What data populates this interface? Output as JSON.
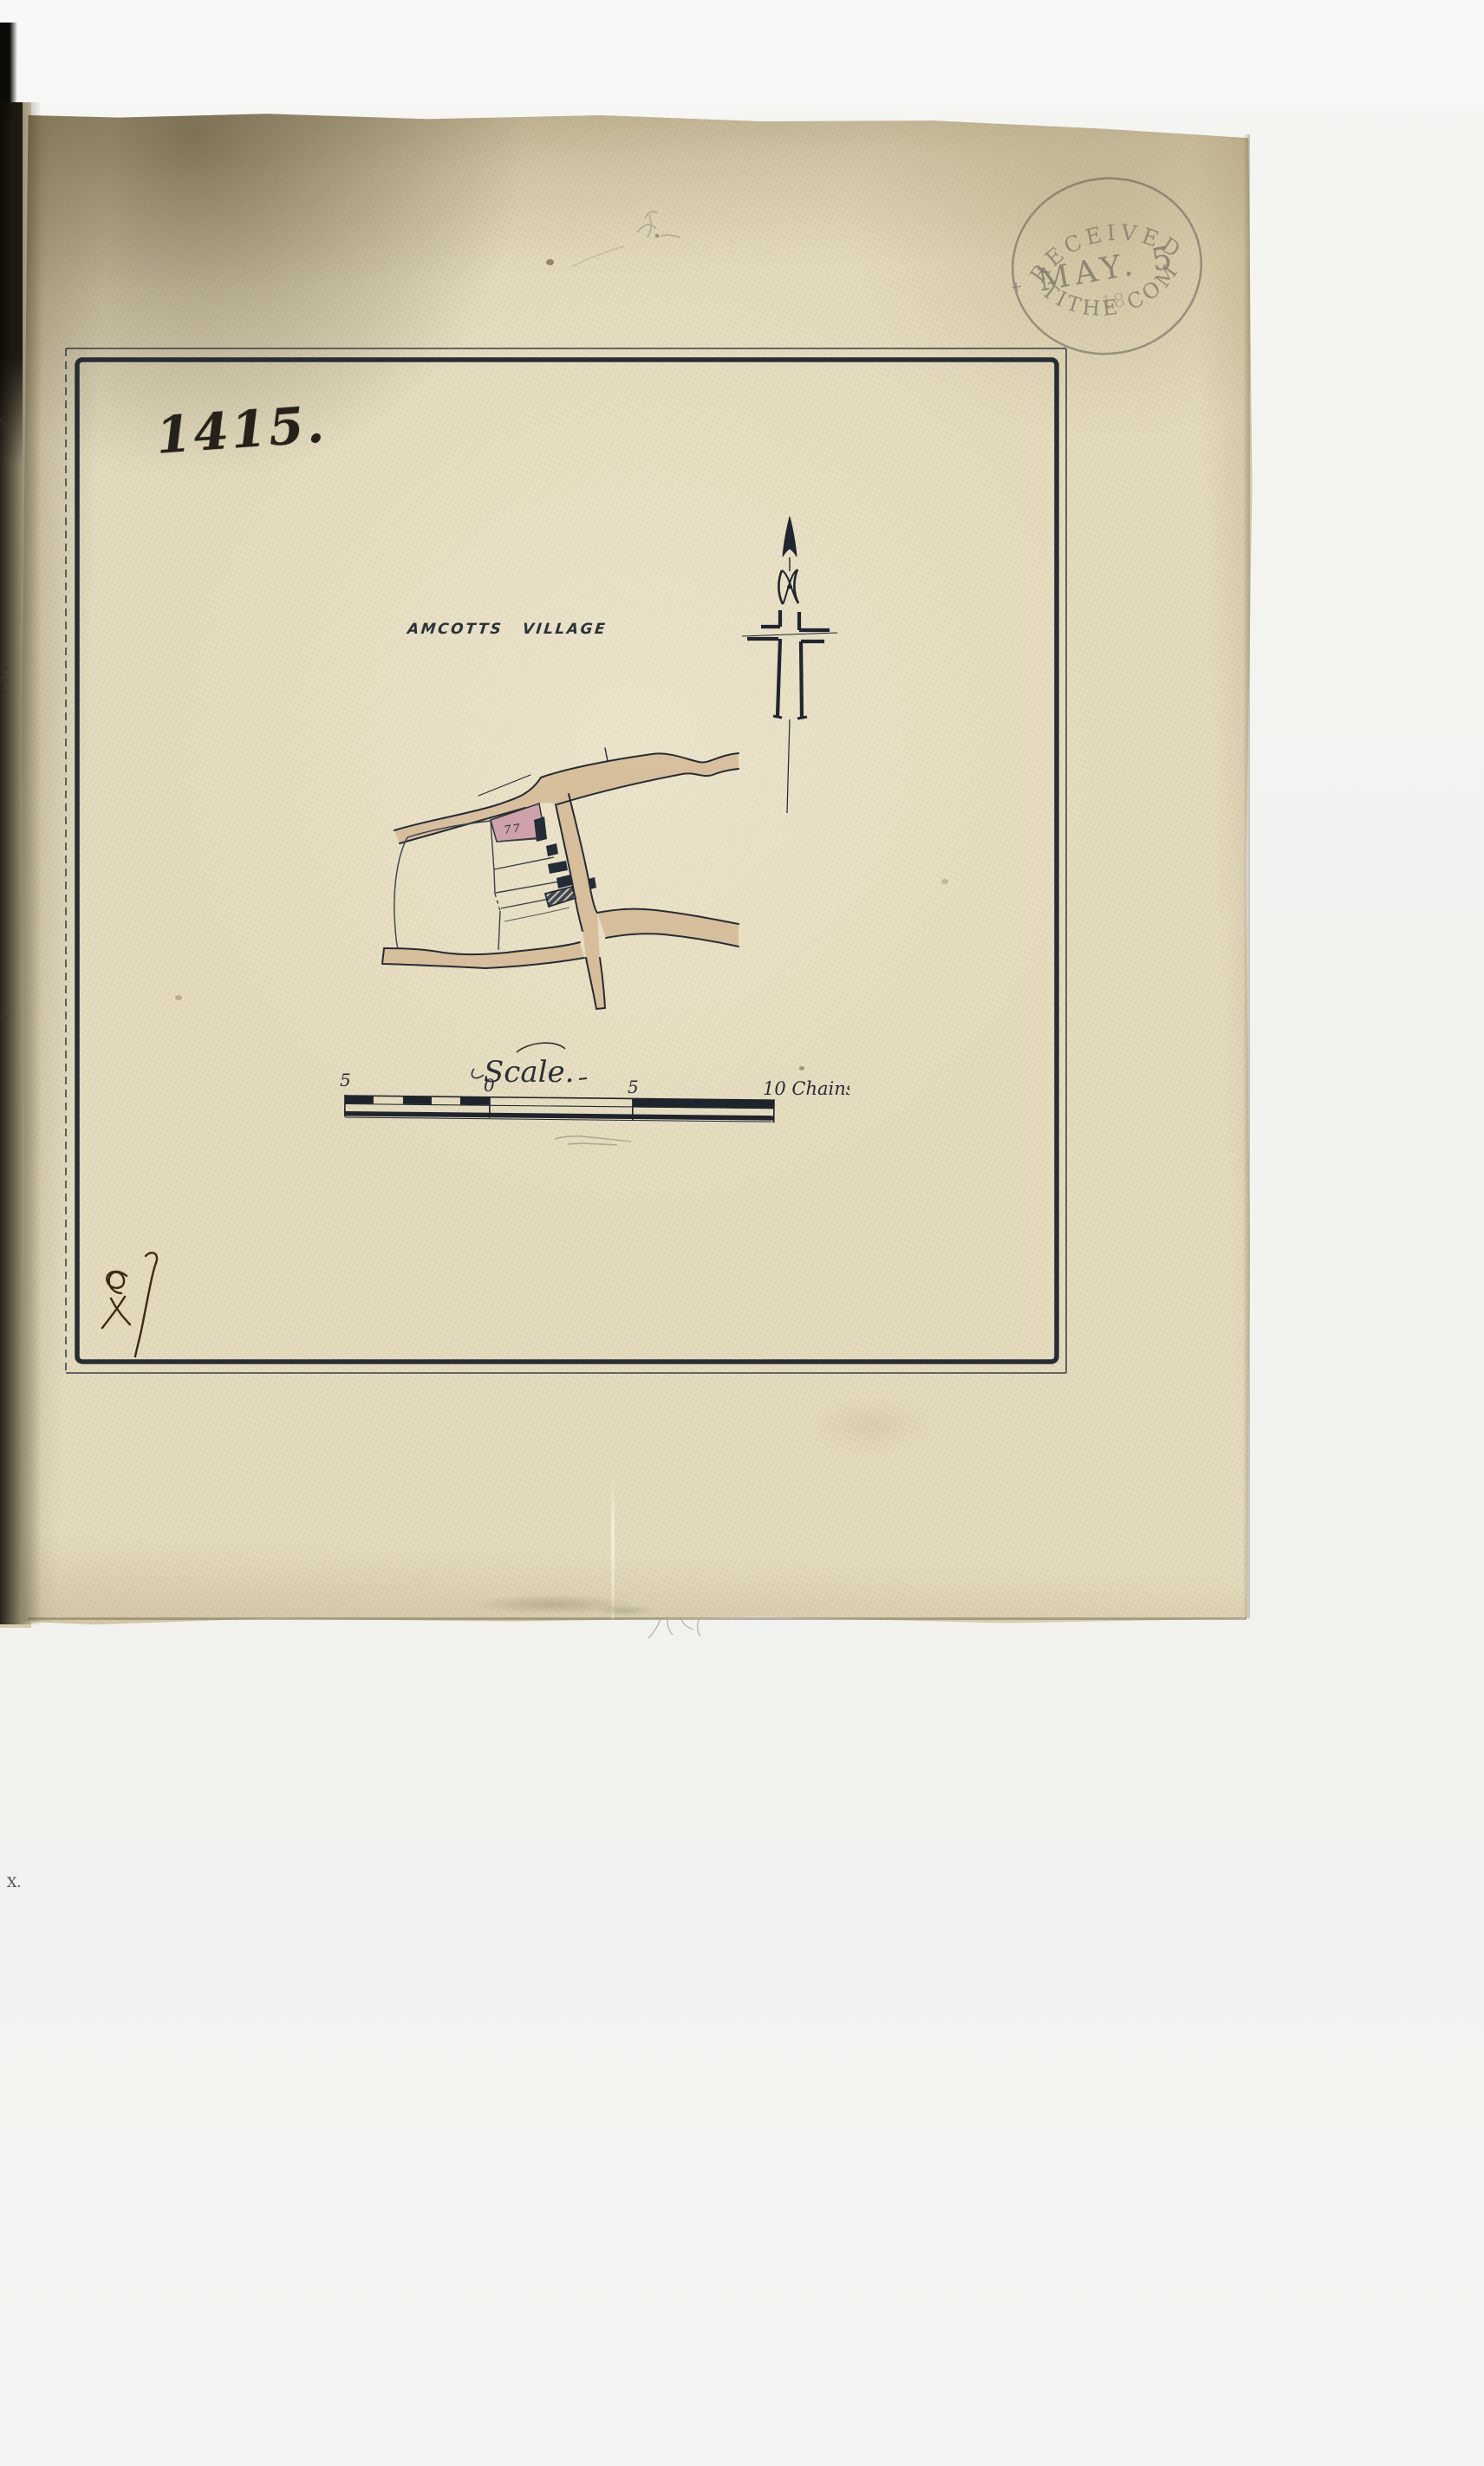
{
  "map": {
    "sheet_number": "1415.",
    "village_label": "AMCOTTS VILLAGE",
    "plot_marks": "77",
    "icons": {
      "compass": "north-arrow-cross-icon",
      "archive_flourish": "handwritten-flourish-mark"
    }
  },
  "scale_bar": {
    "script_label": "Scale.",
    "tick_labels": [
      "5",
      "0",
      "5"
    ],
    "unit_label": "10 Chains"
  },
  "stamp": {
    "arc_top": "RECEIVED",
    "date_line": "MAY. 5",
    "year_fragment": "18",
    "arc_bottom": "TITHE COM",
    "side_mark": "+"
  },
  "margin": {
    "underpage_mark": "X."
  },
  "colors": {
    "parchment": "#e6ddc0",
    "ink": "#272e38",
    "road_fill": "#d5ba96",
    "plot_pink": "#cfa2ab",
    "stamp_ink": "#55544e",
    "background": "#f4f4f1"
  }
}
